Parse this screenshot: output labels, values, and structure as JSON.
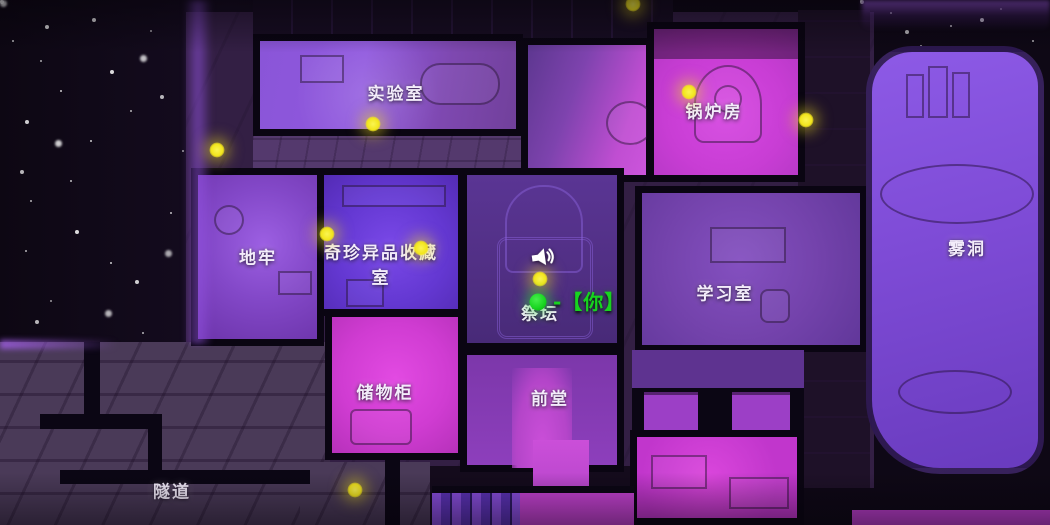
{
  "map": {
    "rooms": {
      "lab": {
        "label": "实验室"
      },
      "boiler_room": {
        "label": "锅炉房"
      },
      "dungeon": {
        "label": "地牢"
      },
      "curio_collection": {
        "label": "奇珍异品收藏室"
      },
      "altar": {
        "label": "祭坛"
      },
      "study": {
        "label": "学习室"
      },
      "fog_cave": {
        "label": "雾洞"
      },
      "storage": {
        "label": "储物柜"
      },
      "front_hall": {
        "label": "前堂"
      },
      "tunnel": {
        "label": "隧道"
      }
    },
    "player": {
      "label": "-【你】",
      "x": 538,
      "y": 302,
      "color": "#17d41f"
    },
    "speaker": {
      "x": 543,
      "y": 257
    },
    "lights": {
      "color": "#f2e51c",
      "positions": [
        {
          "x": 217,
          "y": 150
        },
        {
          "x": 373,
          "y": 124
        },
        {
          "x": 633,
          "y": 4
        },
        {
          "x": 689,
          "y": 92
        },
        {
          "x": 806,
          "y": 120
        },
        {
          "x": 327,
          "y": 234
        },
        {
          "x": 421,
          "y": 248
        },
        {
          "x": 540,
          "y": 279
        },
        {
          "x": 355,
          "y": 490
        }
      ]
    },
    "colors": {
      "background": "#0e0815",
      "magenta_room": "#cc3fd6",
      "purple_room": "#7b48c2",
      "indigo_room": "#6038cc",
      "dark_violet_room": "#53308a",
      "label_text": "#f3ecfa"
    }
  }
}
